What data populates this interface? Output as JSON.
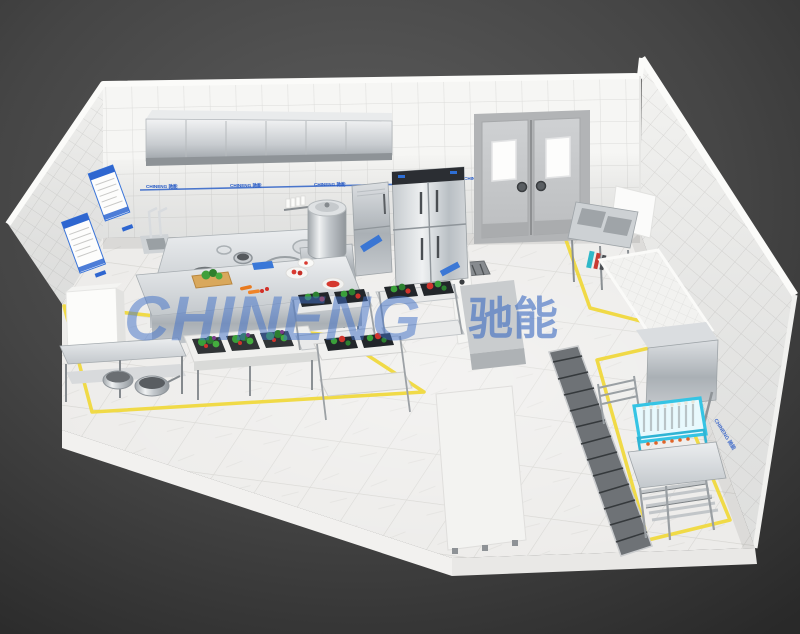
{
  "scene": {
    "watermark": {
      "latin": "CHINENG",
      "chinese": "驰能"
    },
    "wall_label": "CHINENG 驰能",
    "colors": {
      "background_dark": "#3a3a3a",
      "wall_tile_white": "#f5f5f3",
      "floor_marble": "#edecea",
      "safety_line_yellow": "#f0d838",
      "watermark_blue": "#4070c8",
      "label_blue": "#2257c5",
      "stainless_steel": "#c9cdd1",
      "dish_rack_cyan": "#38c6e5",
      "vegetable_green": "#3da23d",
      "tomato_red": "#d9362c",
      "carrot_orange": "#e87a1e",
      "door_gray": "#c6c8ca"
    },
    "objects": [
      "exhaust-hood",
      "wok-cooking-range",
      "condiment-rack",
      "soup-kettle",
      "steamer-cabinet",
      "four-door-refrigerator",
      "double-swing-doors",
      "left-wall-posters",
      "prep-island-table",
      "vegetable-sink-table",
      "vegetable-tray-racks",
      "tier-shelf",
      "pot-table",
      "white-storage-cabinet",
      "right-sink-table",
      "wall-cabinet",
      "tiled-partition",
      "service-counter",
      "floor-trench-drain",
      "hood-type-dishwasher",
      "cyan-dish-rack",
      "pot-tube-shelf",
      "yellow-floor-markings"
    ]
  }
}
